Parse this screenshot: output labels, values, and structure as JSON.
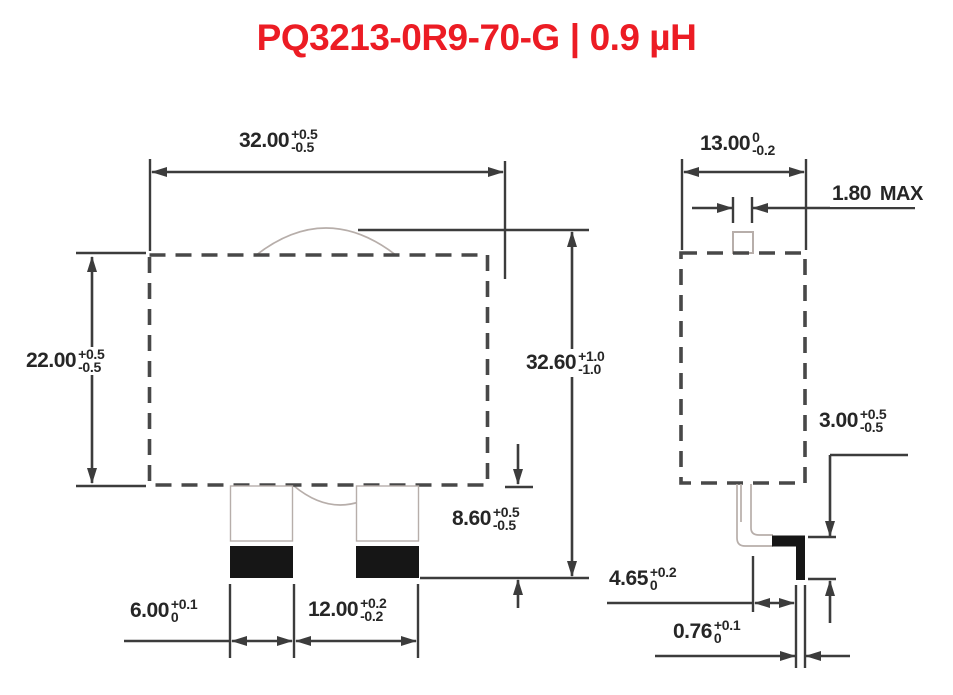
{
  "header": {
    "part_number": "PQ3213-0R9-70-G",
    "separator": "|",
    "inductance": "0.9 µH",
    "accent_color": "#ec1c24"
  },
  "drawing": {
    "line_color": "#3c3c3c",
    "detail_color": "#b7aeaa",
    "pad_color": "#161616"
  },
  "views": {
    "front": {
      "dimensions": {
        "width": {
          "value": "32.00",
          "tol_plus": "+0.5",
          "tol_minus": "-0.5"
        },
        "body_height": {
          "value": "22.00",
          "tol_plus": "+0.5",
          "tol_minus": "-0.5"
        },
        "total_height": {
          "value": "32.60",
          "tol_plus": "+1.0",
          "tol_minus": "-1.0"
        },
        "pin_length": {
          "value": "8.60",
          "tol_plus": "+0.5",
          "tol_minus": "-0.5"
        },
        "pad_width": {
          "value": "6.00",
          "tol_plus": "+0.1",
          "tol_minus": "0"
        },
        "pad_pitch": {
          "value": "12.00",
          "tol_plus": "+0.2",
          "tol_minus": "-0.2"
        }
      }
    },
    "side": {
      "dimensions": {
        "depth": {
          "value": "13.00",
          "tol_plus": "0",
          "tol_minus": "-0.2"
        },
        "tab_width": {
          "value": "1.80",
          "suffix": "MAX"
        },
        "foot_height": {
          "value": "3.00",
          "tol_plus": "+0.5",
          "tol_minus": "-0.5"
        },
        "foot_length": {
          "value": "4.65",
          "tol_plus": "+0.2",
          "tol_minus": "0"
        },
        "lead_thickness": {
          "value": "0.76",
          "tol_plus": "+0.1",
          "tol_minus": "0"
        }
      }
    }
  }
}
